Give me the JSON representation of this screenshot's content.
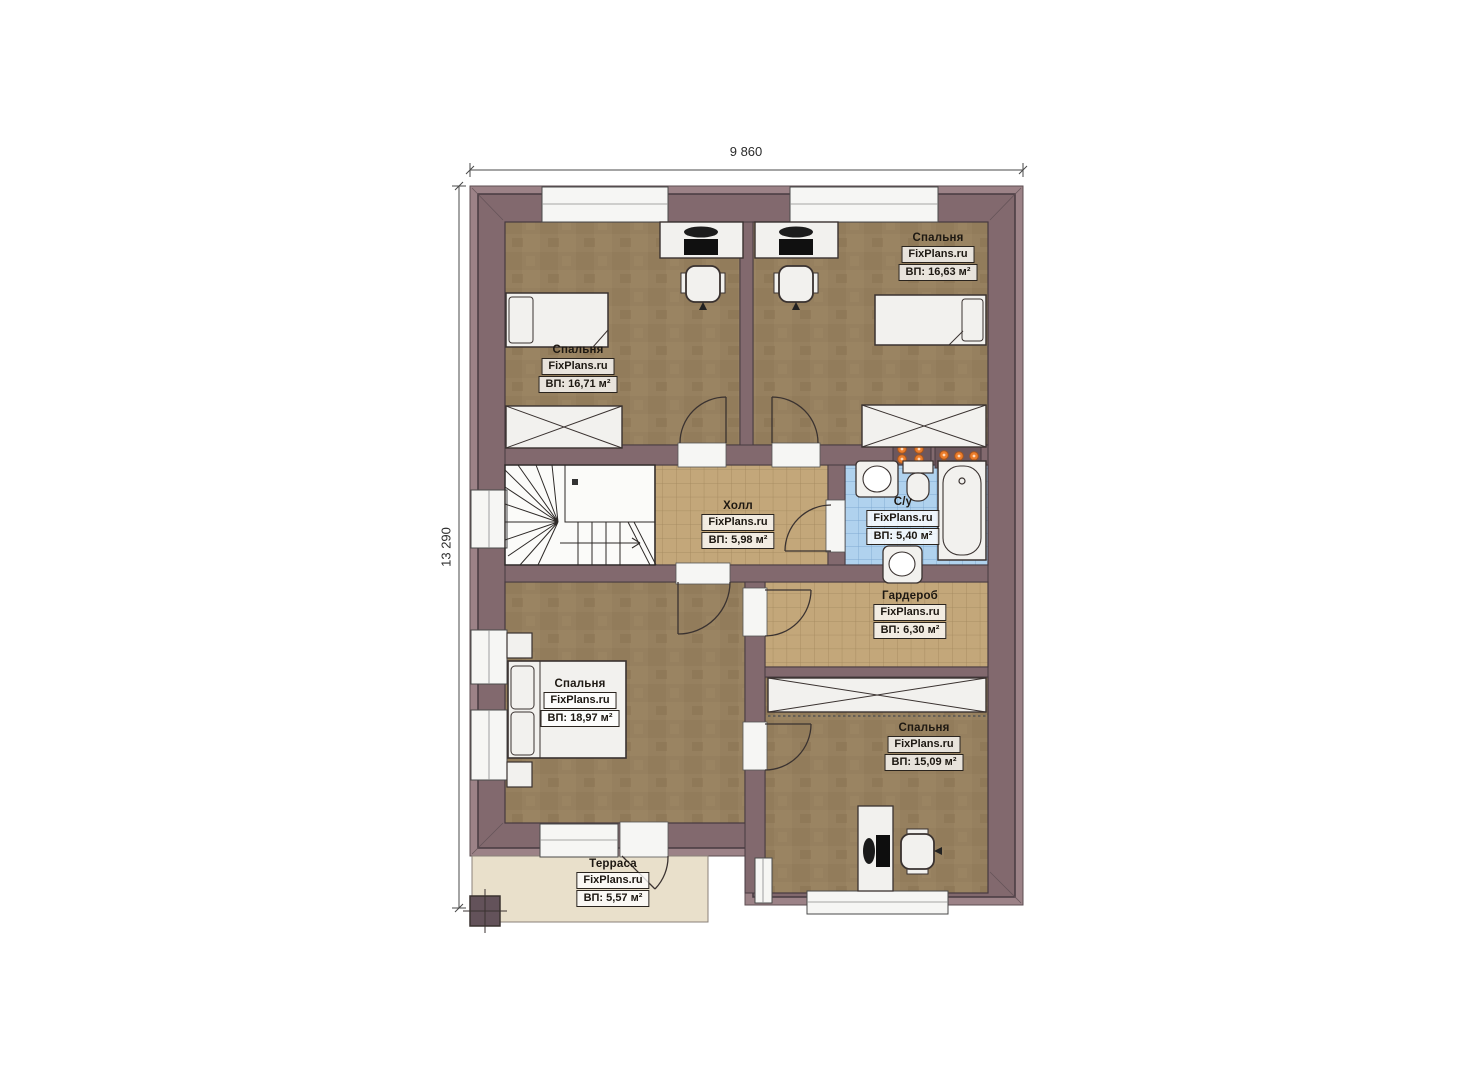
{
  "page": {
    "background": "#ffffff",
    "type": "architectural floor plan"
  },
  "watermark": "FixPlans.ru",
  "dimensions": {
    "width_label": "9 860",
    "height_label": "13 290"
  },
  "rooms": [
    {
      "key": "bedroom_top_left",
      "name": "Спальня",
      "brand": "FixPlans.ru",
      "area": "ВП: 16,71 м²"
    },
    {
      "key": "bedroom_top_right",
      "name": "Спальня",
      "brand": "FixPlans.ru",
      "area": "ВП: 16,63 м²"
    },
    {
      "key": "hall",
      "name": "Холл",
      "brand": "FixPlans.ru",
      "area": "ВП: 5,98 м²"
    },
    {
      "key": "bathroom",
      "name": "С/у",
      "brand": "FixPlans.ru",
      "area": "ВП: 5,40 м²"
    },
    {
      "key": "wardrobe",
      "name": "Гардероб",
      "brand": "FixPlans.ru",
      "area": "ВП: 6,30 м²"
    },
    {
      "key": "bedroom_bottom_left",
      "name": "Спальня",
      "brand": "FixPlans.ru",
      "area": "ВП: 18,97 м²"
    },
    {
      "key": "bedroom_bottom_right",
      "name": "Спальня",
      "brand": "FixPlans.ru",
      "area": "ВП: 15,09 м²"
    },
    {
      "key": "terrace",
      "name": "Терраса",
      "brand": "FixPlans.ru",
      "area": "ВП: 5,57 м²"
    }
  ],
  "colors": {
    "wall": "#82696e",
    "wall_light": "#9c8287",
    "wall_outline": "#473a40",
    "floor_bedroom": "#96805f",
    "floor_tile_tan": "#c3a77a",
    "floor_tile_blue": "#b0d2ee",
    "terrace_floor": "#e9e0cb",
    "furniture": "#f2f1ee",
    "radiator_dot": "#ed7d2b",
    "stairs": "#fbfbf9"
  }
}
